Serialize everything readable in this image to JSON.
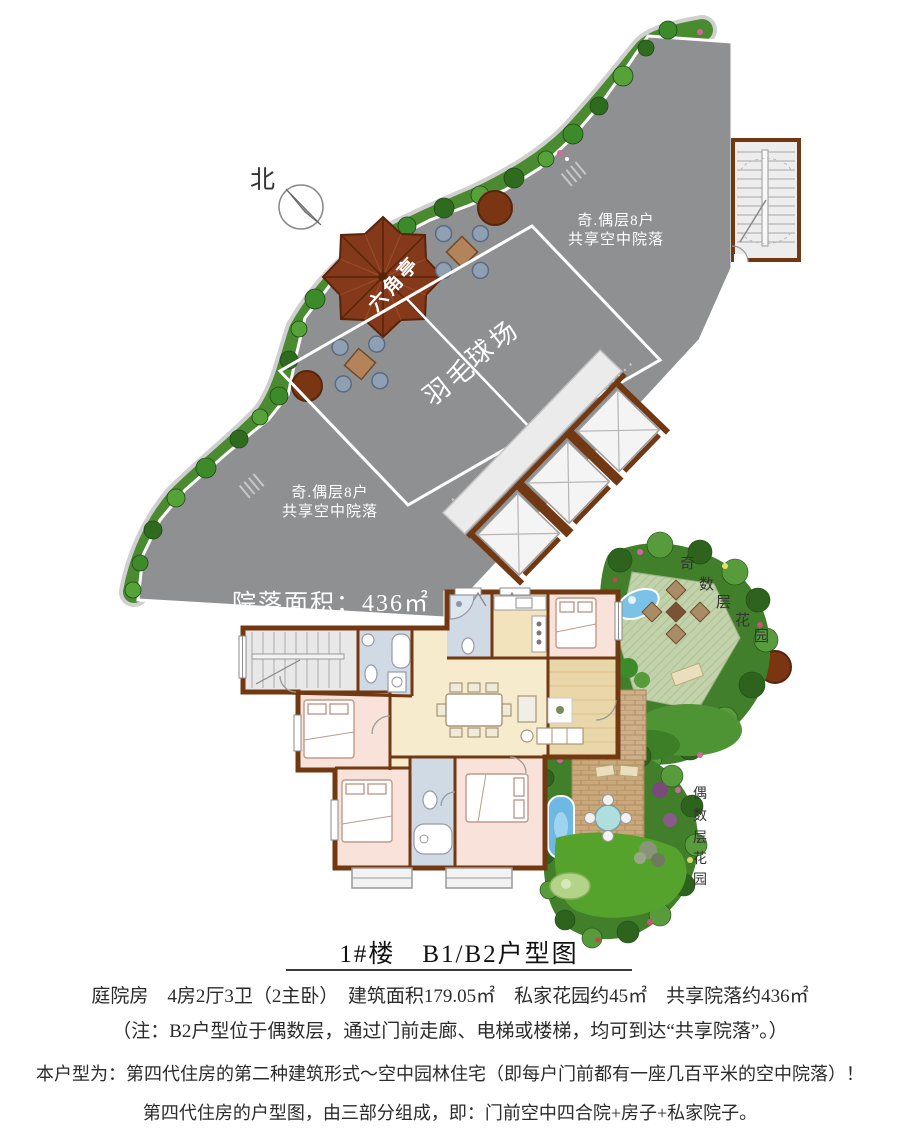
{
  "compass": {
    "label": "北"
  },
  "courtyard": {
    "note_top": {
      "line1": "奇.偶层8户",
      "line2": "共享空中院落"
    },
    "note_bottom": {
      "line1": "奇.偶层8户",
      "line2": "共享空中院落"
    },
    "area_label": "院落面积：436㎡",
    "pavilion_label": "六角亭",
    "court_label_upper": "球场",
    "court_label_lower": "羽毛"
  },
  "gardens": {
    "odd_chars": [
      "奇",
      "数",
      "层",
      "花",
      "园"
    ],
    "even_chars": [
      "偶",
      "数",
      "层",
      "花",
      "园"
    ]
  },
  "footer": {
    "title": "1#楼　B1/B2户型图",
    "line1": "庭院房　4房2厅3卫（2主卧）　建筑面积179.05㎡　私家花园约45㎡　共享院落约436㎡",
    "line2": "（注：B2户型位于偶数层，通过门前走廊、电梯或楼梯，均可到达“共享院落”。）",
    "line3": "本户型为：第四代住房的第二种建筑形式～空中园林住宅（即每户门前都有一座几百平米的空中院落）！",
    "line4": "第四代住房的户型图，由三部分组成，即：门前空中四合院+房子+私家院子。"
  },
  "colors": {
    "courtyard_gray": "#8f9092",
    "green_strip": "#4a8a30",
    "pavilion_roof": "#84391a",
    "wall_brown": "#713812",
    "lawn_green": "#c2d2aa",
    "pool_blue": "#7cc2e8",
    "room_cream": "#f6ebcd",
    "bedroom_pink": "#f8e2da",
    "bath_blue": "#cfdae4"
  }
}
